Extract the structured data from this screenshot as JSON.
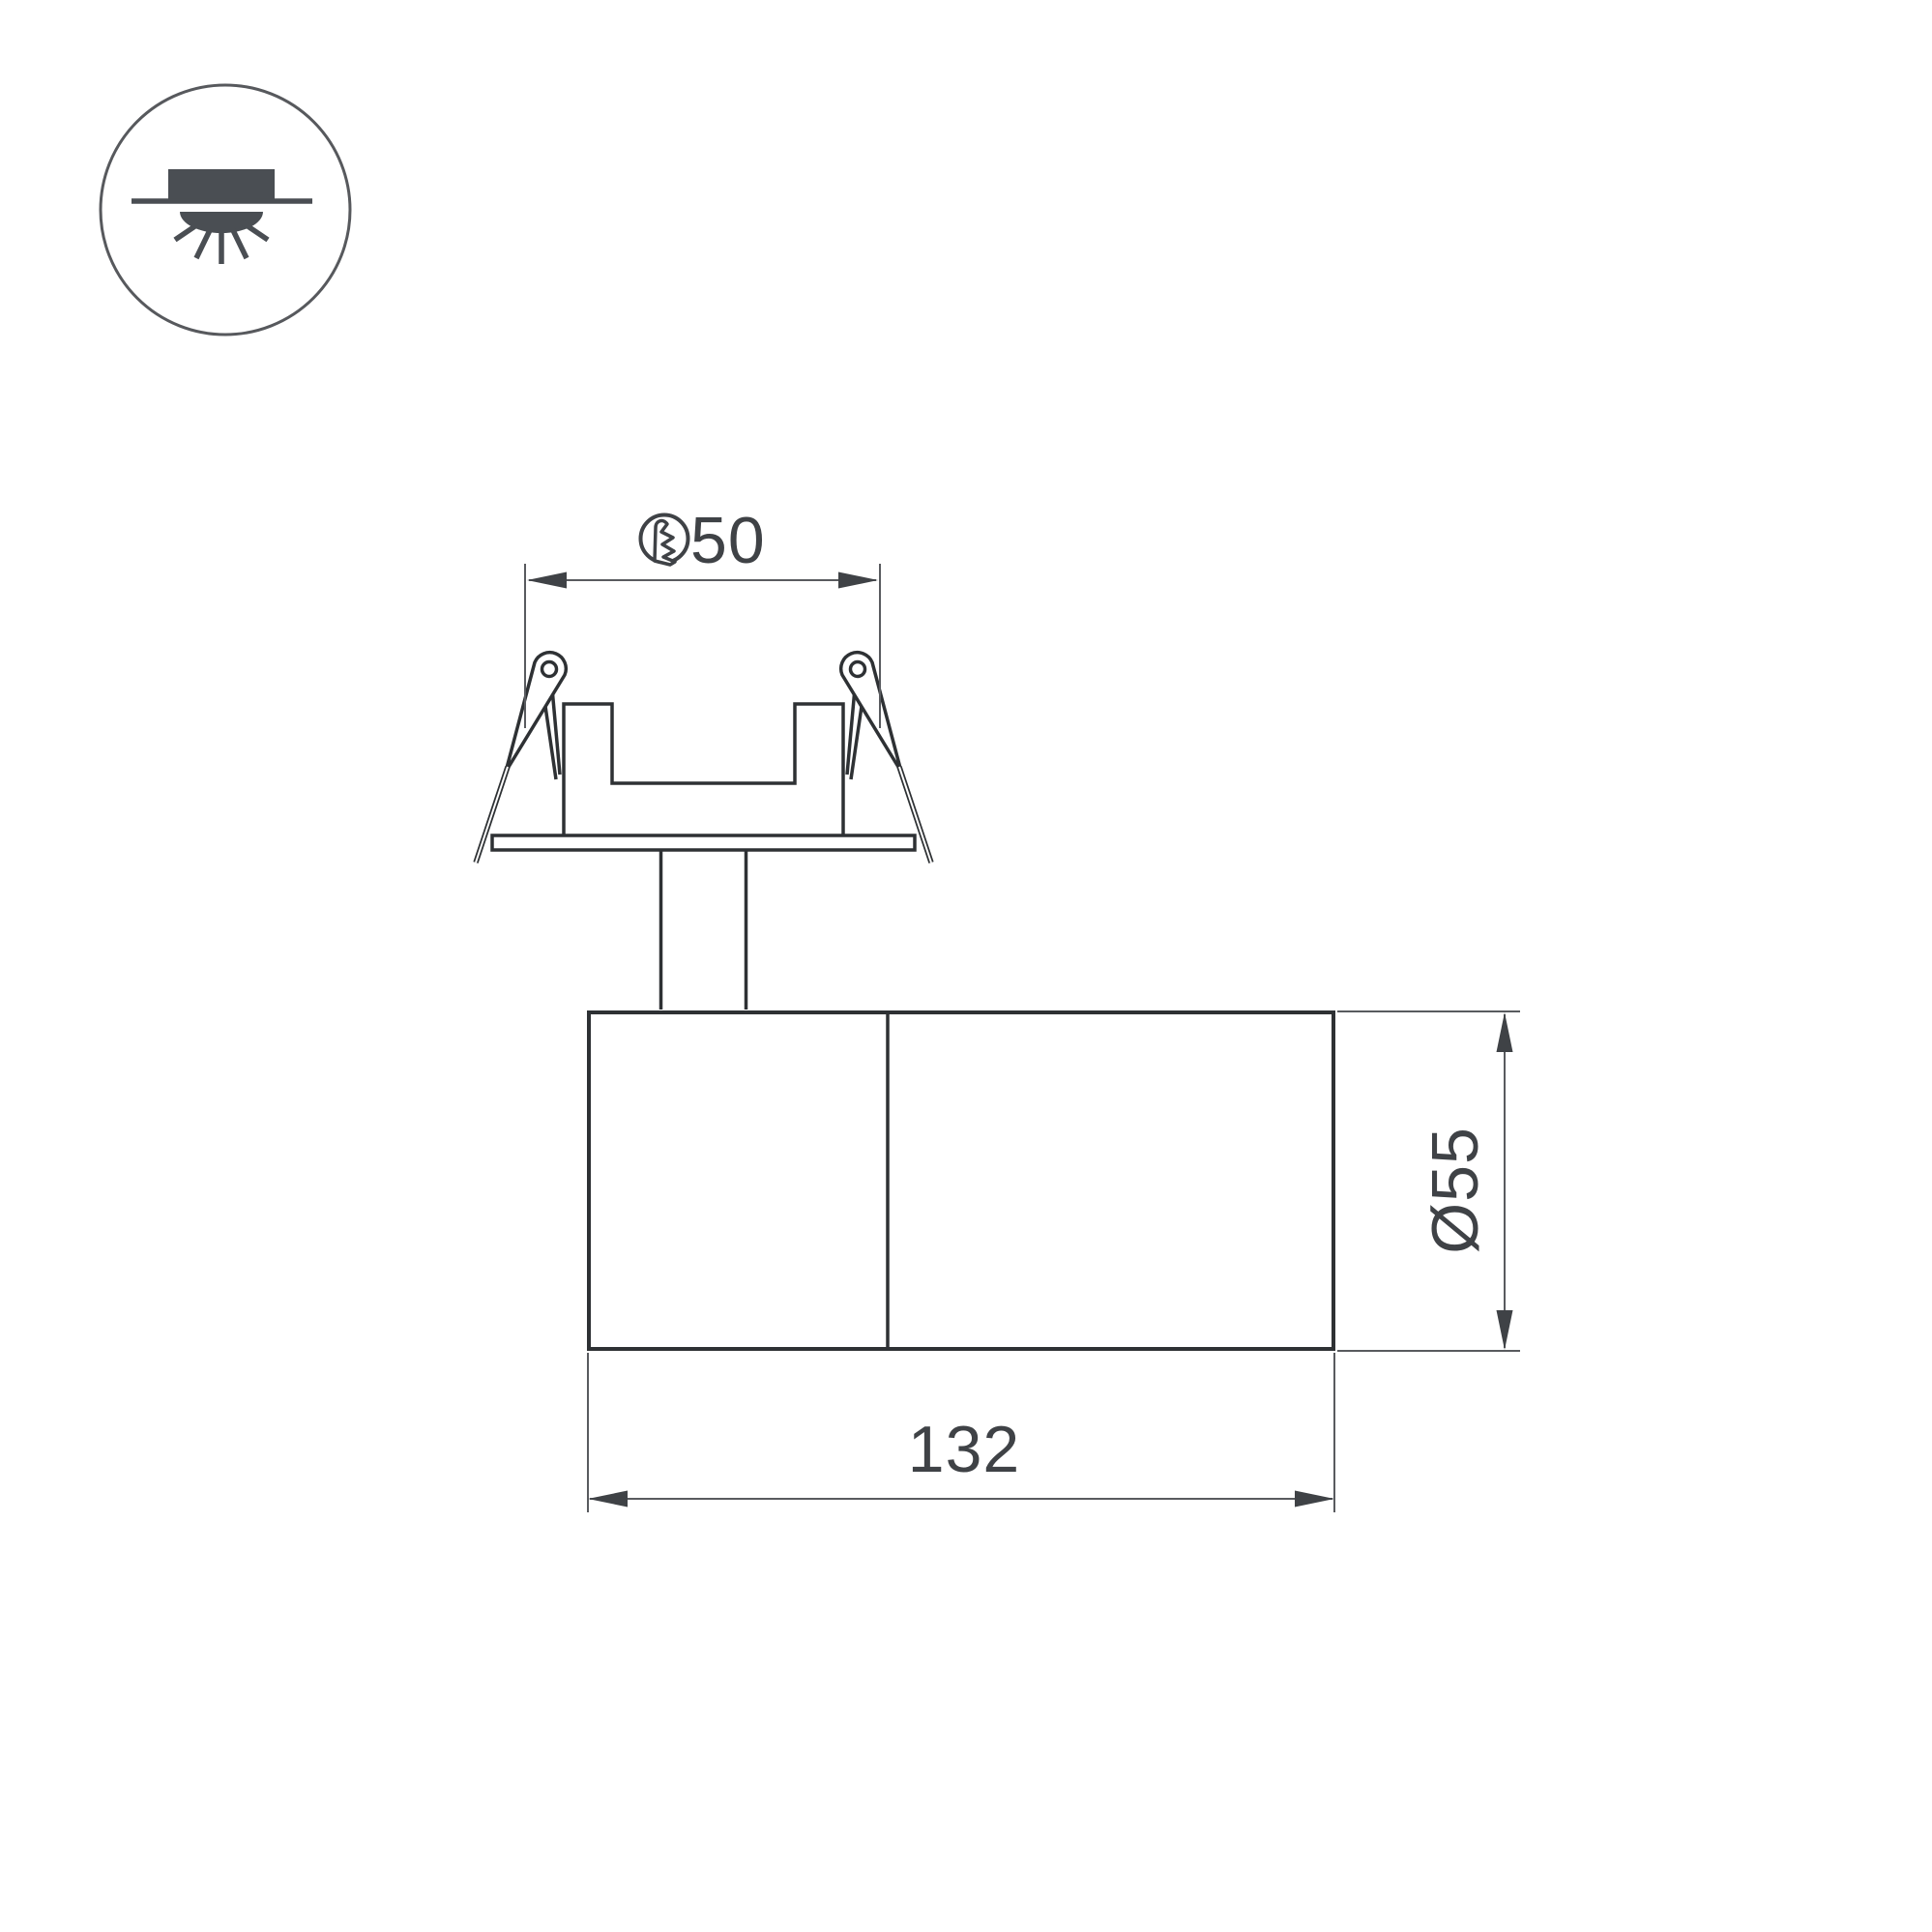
{
  "legend": {
    "icon": "recessed-downlight-mounting-icon"
  },
  "drawing": {
    "type": "technical-drawing",
    "subject": "recessed adjustable spotlight, side view with mounting springs",
    "dimensions": {
      "cutout": {
        "symbol_icon": "hole-cutout-icon",
        "value": "50"
      },
      "diameter": {
        "value": "Ø55"
      },
      "length": {
        "value": "132"
      }
    }
  },
  "colors": {
    "background": "#ffffff",
    "outline": "#2e3134",
    "dimension_line": "#595b5f",
    "dimension_text": "#3f4246",
    "legend_icon": "#4a4e53"
  }
}
